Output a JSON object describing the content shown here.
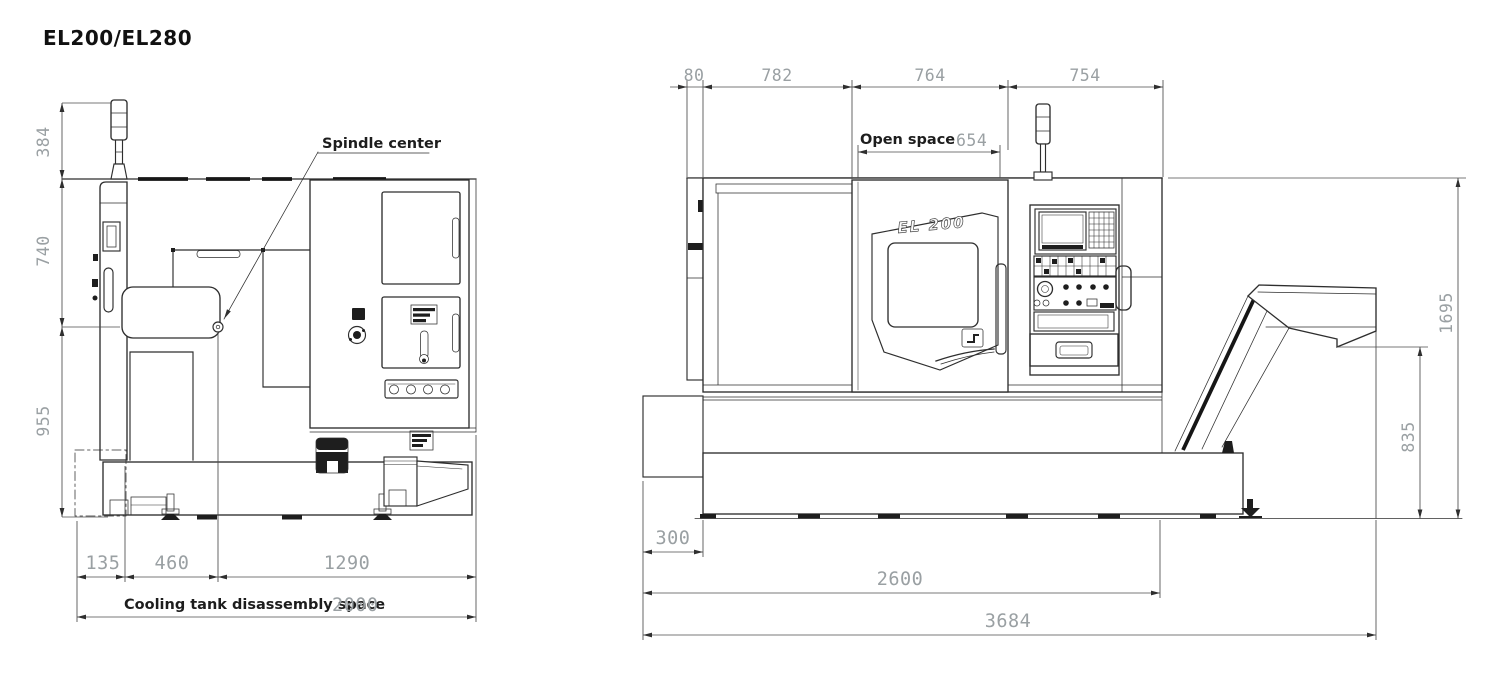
{
  "title": "EL200/EL280",
  "colors": {
    "background": "#ffffff",
    "line": "#2e2e2e",
    "dim_text": "#9aa0a3",
    "label_text": "#1d1d1d"
  },
  "left_view": {
    "labels": {
      "spindle_center": "Spindle center",
      "cooling_tank": "Cooling tank disassembly space"
    },
    "dims": {
      "d384": "384",
      "d740": "740",
      "d955": "955",
      "d135": "135",
      "d460": "460",
      "d1290": "1290",
      "d2000": "2000"
    }
  },
  "right_view": {
    "labels": {
      "open_space": "Open space",
      "model_badge": "EL 200"
    },
    "dims": {
      "d80": "80",
      "d782": "782",
      "d764": "764",
      "d754": "754",
      "d654": "654",
      "d1695": "1695",
      "d835": "835",
      "d300": "300",
      "d2600": "2600",
      "d3684": "3684"
    }
  }
}
